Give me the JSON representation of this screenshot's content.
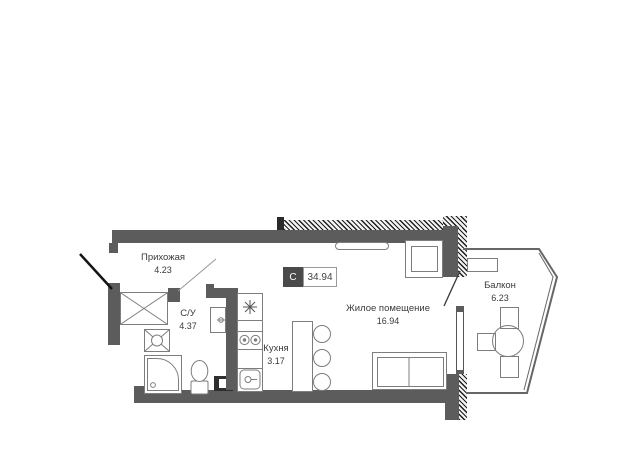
{
  "plan_title": "Studio apartment floor plan",
  "rooms": [
    {
      "name": "Прихожая",
      "area": "4.23"
    },
    {
      "name": "С/У",
      "area": "4.37"
    },
    {
      "name": "Кухня",
      "area": "3.17"
    },
    {
      "name": "Жилое помещение",
      "area": "16.94"
    },
    {
      "name": "Балкон",
      "area": "6.23"
    }
  ],
  "total_badge": {
    "section": "C",
    "area": "34.94"
  },
  "colors": {
    "wall": "#5c5c5c",
    "furniture_line": "#7d7d7d",
    "text": "#3a3a3a",
    "badge_bg": "#4a4a4a",
    "badge_border": "#9a9a9a",
    "door": "#141414",
    "balcony_outline": "#666666"
  },
  "fixtures": [
    "wardrobe",
    "washing-machine",
    "shower",
    "toilet",
    "washbasin",
    "fridge",
    "stove",
    "kitchen-sink",
    "vent-duct",
    "bar-counter",
    "bar-stools",
    "sofa-bed",
    "armchair",
    "radiator",
    "balcony-shelf",
    "balcony-table",
    "balcony-chairs"
  ]
}
